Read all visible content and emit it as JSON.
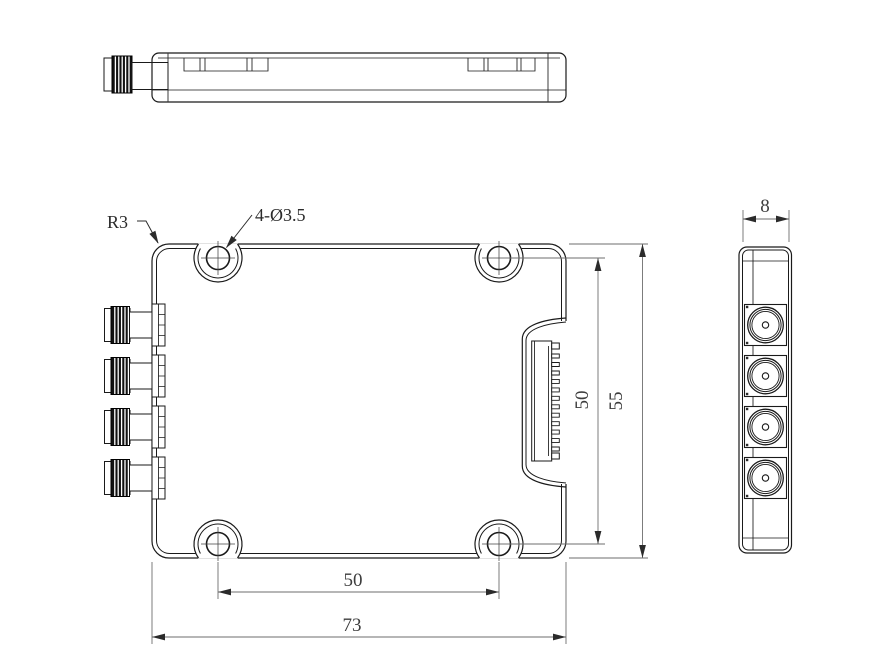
{
  "annotations": {
    "corner_radius": "R3",
    "hole_callout": "4-Ø3.5"
  },
  "dimensions": {
    "front_hole_pitch_vertical": "50",
    "front_overall_height": "55",
    "front_hole_pitch_horizontal": "50",
    "front_overall_width": "73",
    "side_overall_thickness": "8"
  },
  "colors": {
    "outline": "#1a1a1a",
    "dimension_lines": "#6e6e6e",
    "text": "#3d3d3d",
    "background": "#ffffff"
  }
}
